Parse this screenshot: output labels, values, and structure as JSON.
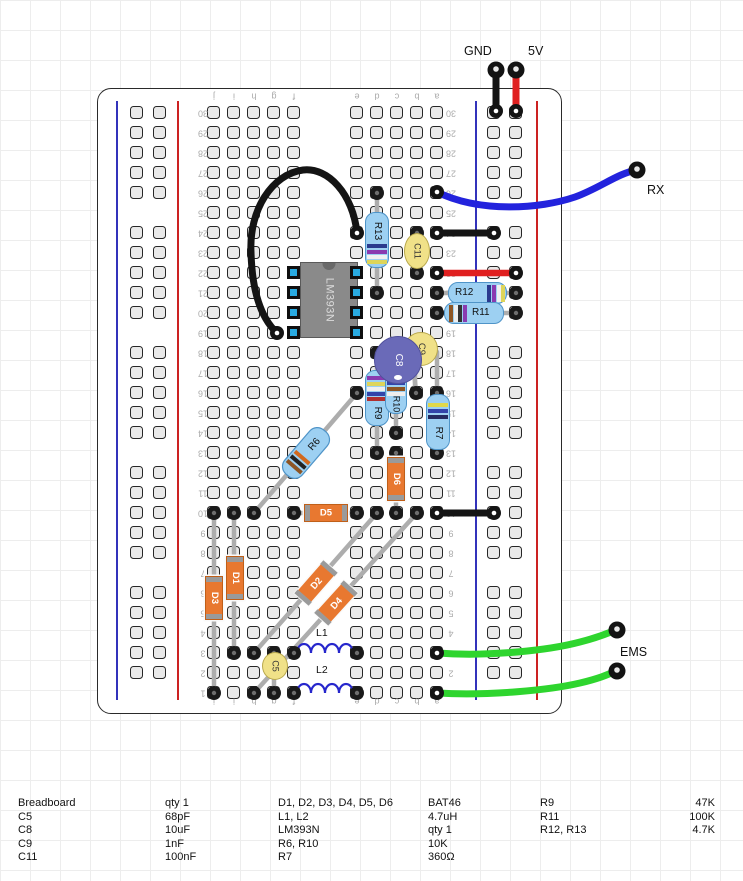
{
  "terminals": {
    "gnd_label": "GND",
    "v5_label": "5V",
    "rx_label": "RX",
    "ems_label": "EMS"
  },
  "breadboard": {
    "column_letters": [
      "j",
      "i",
      "h",
      "g",
      "f",
      "e",
      "d",
      "c",
      "b",
      "a"
    ],
    "row_numbers": [
      1,
      2,
      3,
      4,
      5,
      6,
      7,
      8,
      9,
      10,
      11,
      12,
      13,
      14,
      15,
      16,
      17,
      18,
      19,
      20,
      21,
      22,
      23,
      24,
      25,
      26,
      27,
      28,
      29,
      30
    ]
  },
  "components": {
    "ic": "LM393N",
    "r6": "R6",
    "r7": "R7",
    "r9": "R9",
    "r10": "R10",
    "r11": "R11",
    "r12": "R12",
    "r13": "R13",
    "c5": "C5",
    "c8": "C8",
    "c9": "C9",
    "c11": "C11",
    "d1": "D1",
    "d2": "D2",
    "d3": "D3",
    "d4": "D4",
    "d5": "D5",
    "d6": "D6",
    "l1": "L1",
    "l2": "L2"
  },
  "colors": {
    "wire_black": "#141414",
    "wire_red": "#e02020",
    "wire_blue": "#2323dd",
    "wire_green": "#2ed52e",
    "rail_blue": "#3333bb",
    "rail_red": "#cc2222",
    "resistor_body": "#9dd0f2",
    "diode_body": "#e87830",
    "ic_body": "#8a8a8a",
    "pin_blue": "#29abe2",
    "cap_yellow": "#f0e188",
    "cap_purple": "#6a6ab8"
  },
  "parts_list": {
    "rows": [
      [
        "Breadboard",
        "qty 1",
        "D1, D2, D3, D4, D5, D6",
        "BAT46",
        "R9",
        "47K"
      ],
      [
        "C5",
        "68pF",
        "L1, L2",
        "4.7uH",
        "R11",
        "100K"
      ],
      [
        "C8",
        "10uF",
        "LM393N",
        "qty 1",
        "R12, R13",
        "4.7K"
      ],
      [
        "C9",
        "1nF",
        "R6, R10",
        "10K",
        "",
        ""
      ],
      [
        "C11",
        "100nF",
        "R7",
        "360Ω",
        "",
        ""
      ]
    ]
  }
}
